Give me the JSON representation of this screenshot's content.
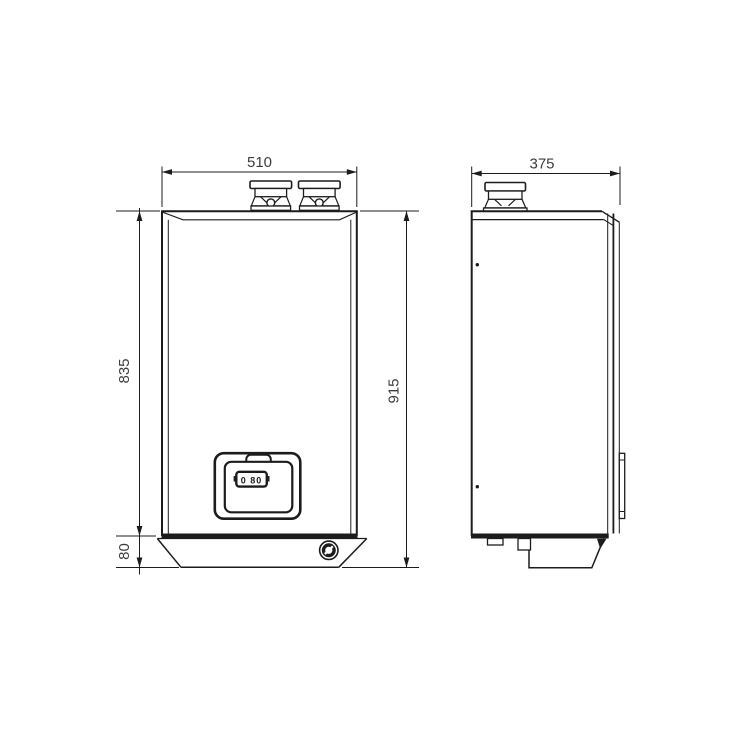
{
  "drawing": {
    "type": "boiler-dimension-drawing",
    "background_color": "#ffffff",
    "line_color": "#1c1c1c",
    "text_color": "#3d3d3d",
    "front_view": {
      "width": "510",
      "body_height": "835",
      "base_height": "80",
      "total_height": "915",
      "panel_display": "0 80"
    },
    "side_view": {
      "depth": "375"
    }
  }
}
